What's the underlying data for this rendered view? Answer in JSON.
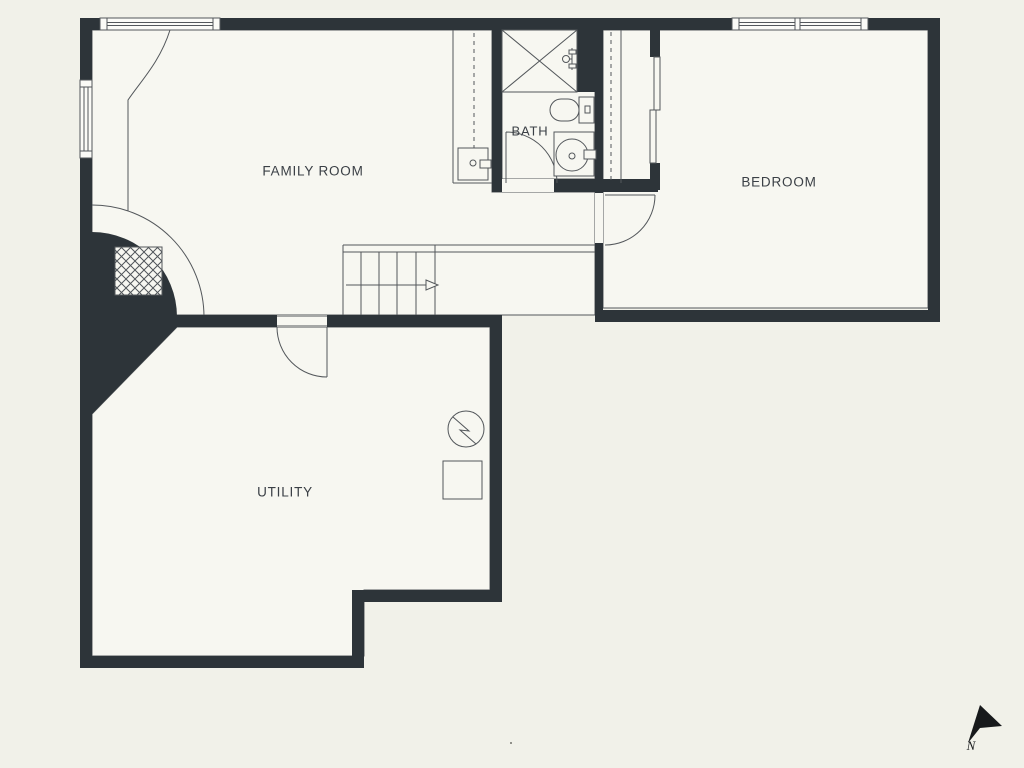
{
  "title": "Basement floor plan",
  "rooms": {
    "family_room": {
      "label": "FAMILY ROOM"
    },
    "bedroom": {
      "label": "BEDROOM"
    },
    "bath": {
      "label": "BATH"
    },
    "utility": {
      "label": "UTILITY"
    }
  },
  "compass": {
    "label": "N"
  },
  "features": [
    "staircase-with-direction-arrow",
    "fireplace-with-hatched-firebox",
    "curved-hearth-wall",
    "shower-stall",
    "toilet",
    "sink",
    "laundry-sink",
    "electrical-panel",
    "furnace-box",
    "closet-with-sliding-doors",
    "closet-rod-dashed",
    "windows-top-and-left",
    "north-arrow"
  ],
  "theme": {
    "bg": "#f1f1e9",
    "floor": "#f7f7f1",
    "wall": "#2d3439",
    "line": "#53575b",
    "text": "#3b4046",
    "arrow": "#17191b"
  }
}
